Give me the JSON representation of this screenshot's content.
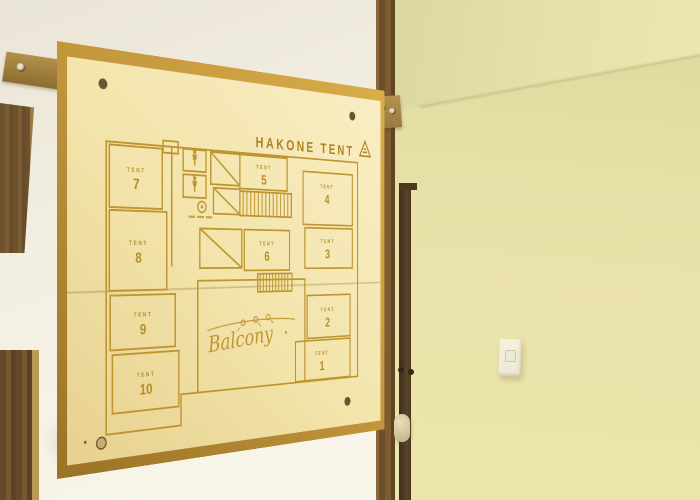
{
  "sign": {
    "title": "HAKONE TENT",
    "balcony_label": "Balcony",
    "rooms": {
      "t1": {
        "label": "TENT",
        "number": "1"
      },
      "t2": {
        "label": "TENT",
        "number": "2"
      },
      "t3": {
        "label": "TENT",
        "number": "3"
      },
      "t4": {
        "label": "TENT",
        "number": "4"
      },
      "t5": {
        "label": "TENT",
        "number": "5"
      },
      "t6": {
        "label": "TENT",
        "number": "6"
      },
      "t7": {
        "label": "TENT",
        "number": "7"
      },
      "t8": {
        "label": "TENT",
        "number": "8"
      },
      "t9": {
        "label": "TENT",
        "number": "9"
      },
      "t10": {
        "label": "TENT",
        "number": "10"
      }
    },
    "icons": [
      "tent-logo-triangle-icon",
      "person-icon",
      "person-icon",
      "laundry-machine-icon"
    ],
    "colors": {
      "sign_face": "#f3e4ab",
      "engraving_gold": "#bf9530",
      "frame_amber": "#c0923a",
      "side_wall_olive": "#e7e1a8",
      "front_wall_white": "#f4f0e4",
      "dark_wood": "#5c4526"
    }
  }
}
